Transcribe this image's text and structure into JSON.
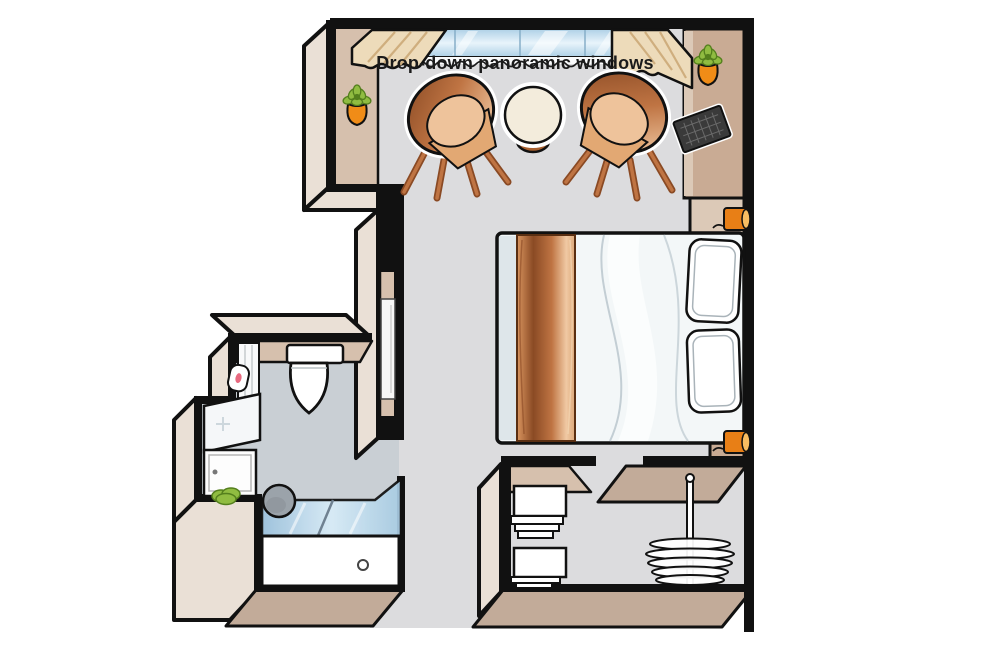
{
  "window": {
    "label": "Drop-down panoramic windows"
  },
  "rooms": [
    "main-cabin",
    "bathroom",
    "entry-hall",
    "wardrobe-closet"
  ],
  "furniture": [
    "panoramic-window",
    "curtain-left",
    "curtain-right",
    "tub-chair-left",
    "tub-chair-right",
    "round-table",
    "double-bed",
    "bed-runner",
    "pillow-top",
    "pillow-bottom",
    "tv",
    "media-cabinet",
    "nightstand",
    "wall-lamp-upper",
    "wall-lamp-lower",
    "wall-plant-left",
    "wall-plant-right",
    "toilet",
    "toilet-paper-holder",
    "vanity-sink",
    "green-towel",
    "shower",
    "shower-head",
    "bathroom-door",
    "closet-shelves",
    "hanger-rod",
    "hangers"
  ],
  "colors": {
    "outline": "#111111",
    "floorMain": "#dcdcde",
    "floorBath": "#c9cfd4",
    "faceLight": "#eae0d6",
    "faceTan": "#d6c0ad",
    "faceDark": "#c2ab99",
    "cabinetDark": "#c9ab94",
    "cabinetLight": "#dcc9b7",
    "copperDark": "#8a4a24",
    "copperMid": "#bf7443",
    "copperLight": "#f0c9a3",
    "tableCream": "#f3ecdc",
    "glassBlue": "#aed0e6",
    "glassPale": "#e8f4fb",
    "curtain": "#eddbba",
    "curtainShade": "#cfae7e",
    "duvet": "#f3f7f8",
    "duvetShade": "#ccd8de",
    "pillowLine": "#a9b3b9",
    "lampOrange": "#e87f16",
    "lampLight": "#f8bd62",
    "plantGreen": "#90bc41",
    "plantDark": "#547f1d",
    "potOrange": "#f08c17",
    "tvDark": "#3a3a3a",
    "tvLine": "#6a6a6a",
    "showerHead": "#9ba3aa",
    "text": "#1b1b1b"
  }
}
